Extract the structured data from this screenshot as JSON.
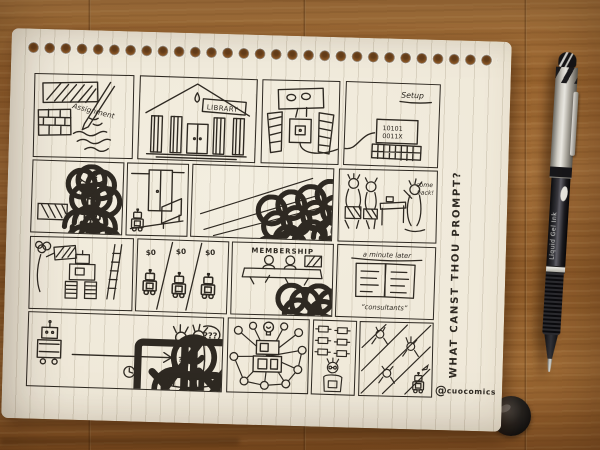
{
  "scene": {
    "description": "Photograph of a hand-drawn comic storyboard on a spiral notebook page lying on a wooden desk, gel pen at right",
    "colors": {
      "ink": "#2e2922",
      "paper": "#efe8d8",
      "wood": "#9c6631"
    }
  },
  "sketch": {
    "row1": {
      "assignment_label": "Assignment",
      "library_label": "LIBRARY",
      "setup_label": "Setup",
      "binary_line1": "10101",
      "binary_line2": "0011X"
    },
    "row2": {
      "greeting": "Hi!",
      "come_back_line1": "come",
      "come_back_line2": "back!"
    },
    "row3": {
      "price1": "$0",
      "price2": "$0",
      "price3": "$0",
      "membership_label": "MEMBERSHIP",
      "caption_minute_later": "a minute later",
      "caption_consultants": "“consultants”"
    },
    "row4": {
      "confusion": "???",
      "torso_question": "?"
    },
    "margin_question": "WHAT CANST THOU PROMPT?",
    "signature_at": "@",
    "signature_name": "cuocomics"
  },
  "pen": {
    "barrel_text": "Liquid Gel Ink"
  }
}
